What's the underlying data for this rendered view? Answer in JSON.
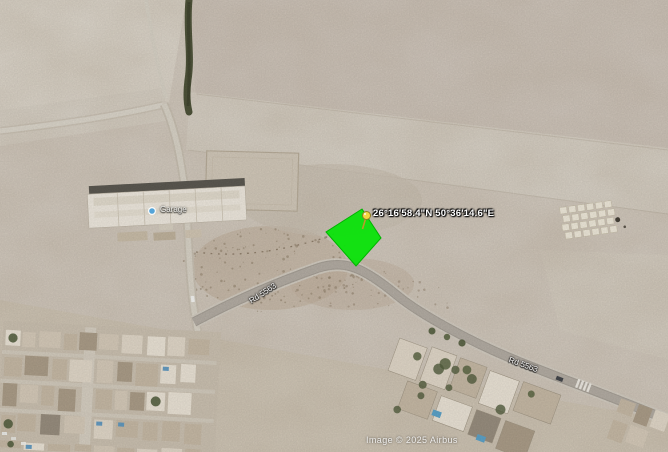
{
  "map": {
    "placemark": {
      "coordinates": "26°16'58.4\"N 50°36'14.6\"E"
    },
    "road_labels": {
      "west": "Rd 5563",
      "east": "Rd 5563"
    },
    "poi": {
      "label": "Garage"
    },
    "attribution": "Image © 2025 Airbus",
    "colors": {
      "plot_polygon": "#09e309",
      "pushpin": "#f2d640",
      "poi_dot": "#55a4d8",
      "terrain_sand": "#d4cbbf"
    }
  }
}
